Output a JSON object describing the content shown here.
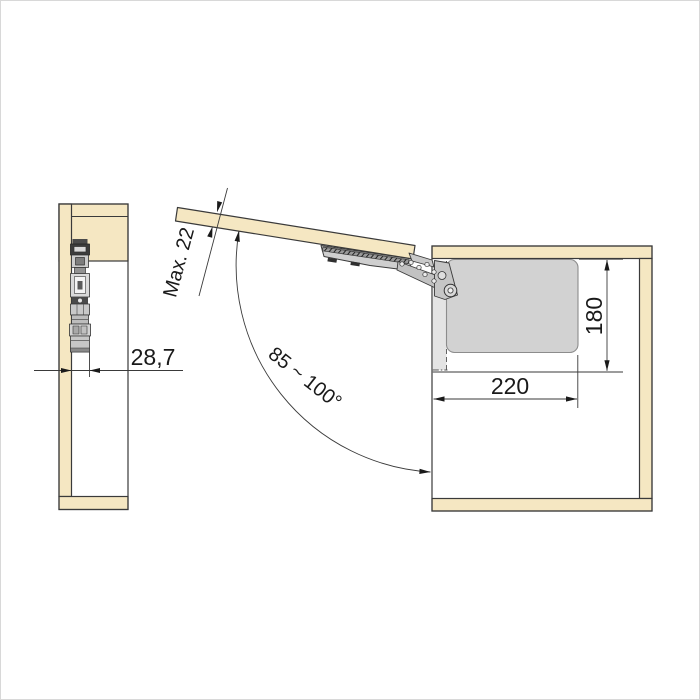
{
  "drawing": {
    "type": "furniture-fitting-technical-diagram",
    "labels": {
      "side_offset": "28,7",
      "door_thickness": "Max. 22",
      "opening_angle": "85 ~ 100°",
      "depth": "220",
      "height": "180"
    },
    "colors": {
      "wood": "#f5e7c2",
      "line": "#3a3a3a",
      "hardware_light": "#d8d8d8",
      "hardware_mid": "#c7c7c7",
      "hardware_dark": "#3c3c3c",
      "clearance_fill": "#d2d2d2",
      "hidden_plate_fill": "#e4e4e4"
    }
  }
}
